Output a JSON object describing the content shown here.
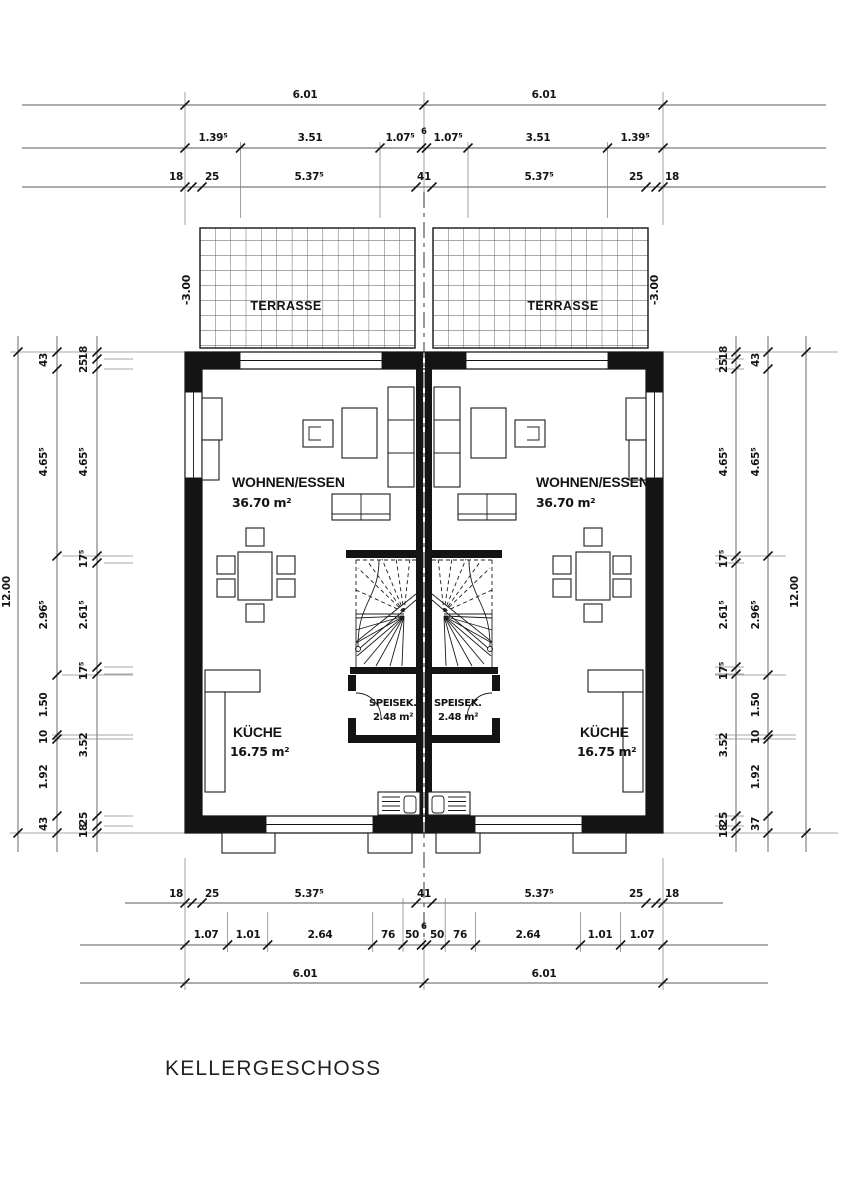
{
  "drawing": {
    "title": "KELLERGESCHOSS"
  },
  "rooms": {
    "living_left": {
      "name": "WOHNEN/ESSEN",
      "area": "36.70 m²"
    },
    "living_right": {
      "name": "WOHNEN/ESSEN",
      "area": "36.70 m²"
    },
    "kitchen_left": {
      "name": "KÜCHE",
      "area": "16.75 m²"
    },
    "kitchen_right": {
      "name": "KÜCHE",
      "area": "16.75 m²"
    },
    "pantry_left": {
      "name": "SPEISEK.",
      "area": "2.48 m²"
    },
    "pantry_right": {
      "name": "SPEISEK.",
      "area": "2.48 m²"
    },
    "terrace_left": {
      "name": "TERRASSE",
      "level": "-3.00"
    },
    "terrace_right": {
      "name": "TERRASSE",
      "level": "-3.00"
    }
  },
  "dims": {
    "top_overall": [
      "6.01",
      "6.01"
    ],
    "top_openings": [
      "1.39⁵",
      "3.51",
      "1.07⁵",
      "6",
      "1.07⁵",
      "3.51",
      "1.39⁵"
    ],
    "top_wall": [
      "18",
      "25",
      "5.37⁵",
      "41",
      "5.37⁵",
      "25",
      "18"
    ],
    "bottom_wall": [
      "18",
      "25",
      "5.37⁵",
      "41",
      "5.37⁵",
      "25",
      "18"
    ],
    "bottom_openings": [
      "1.07",
      "1.01",
      "2.64",
      "76",
      "50",
      "6",
      "50",
      "76",
      "2.64",
      "1.01",
      "1.07"
    ],
    "bottom_overall": [
      "6.01",
      "6.01"
    ],
    "left_overall": "12.00",
    "left_middle": [
      "43",
      "4.65⁵",
      "2.96⁵",
      "1.50",
      "10",
      "1.92",
      "43"
    ],
    "left_inner": [
      "18",
      "25",
      "4.65⁵",
      "17⁵",
      "2.61⁵",
      "17⁵",
      "3.52",
      "25",
      "18"
    ],
    "right_overall": "12.00",
    "right_middle": [
      "43",
      "4.65⁵",
      "2.96⁵",
      "1.50",
      "10",
      "1.92",
      "37"
    ],
    "right_inner": [
      "18",
      "25",
      "4.65⁵",
      "17⁵",
      "2.61⁵",
      "17⁵",
      "3.52",
      "25",
      "18"
    ]
  },
  "colors": {
    "line": "#141414",
    "dim_line": "#5a5a5a",
    "background": "#ffffff"
  }
}
